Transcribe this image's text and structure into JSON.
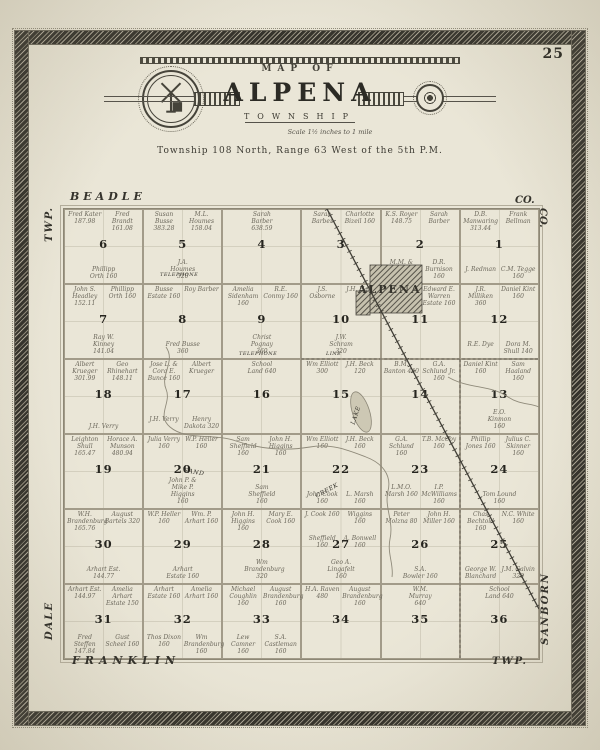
{
  "colors": {
    "paper": "#eae6d7",
    "paper_edge": "#ddd8c6",
    "ink": "#3c3a31",
    "map_line": "#a29b89",
    "owner_ink": "#6b675b",
    "border_band": "#36342d",
    "town_fill": "#56534a"
  },
  "page": {
    "number": "25"
  },
  "title": {
    "arc": "MAP OF",
    "name": "ALPENA",
    "subtitle": "TOWNSHIP",
    "scale": "Scale 1½ inches to 1 mile",
    "legal": "Township 108 North, Range 63 West of the 5th P.M."
  },
  "edges": {
    "top": "BEADLE",
    "top_right": "CO.",
    "right_top": "CO.",
    "right_bottom": "SANBORN",
    "left_top": "TWP.",
    "left_bottom": "DALE",
    "bottom_left": "FRANKLIN",
    "bottom_right": "TWP."
  },
  "map": {
    "labels": [
      {
        "name": "town-label",
        "text": "ALPENA",
        "x": 294,
        "y": 74,
        "size": 11,
        "ls": 2,
        "bold": true
      },
      {
        "name": "lake-label",
        "text": "LAKE",
        "x": 289,
        "y": 212,
        "size": 6,
        "rot": -72
      },
      {
        "name": "creek-label-sand",
        "text": "SAND",
        "x": 120,
        "y": 258,
        "size": 6,
        "rot": 10
      },
      {
        "name": "creek-label-creek",
        "text": "CREEK",
        "x": 252,
        "y": 284,
        "size": 6,
        "rot": -28
      },
      {
        "name": "telephone-label-1",
        "text": "TELEPHONE",
        "x": 96,
        "y": 63,
        "size": 5
      },
      {
        "name": "telephone-label-2",
        "text": "TELEPHONE",
        "x": 175,
        "y": 142,
        "size": 5
      },
      {
        "name": "line-label",
        "text": "LINE",
        "x": 262,
        "y": 142,
        "size": 5
      }
    ],
    "sections": [
      {
        "num": 6,
        "names": [
          "Fred Kater 187.98",
          "Fred Brandt 161.08",
          "Phillipp Orth 160"
        ]
      },
      {
        "num": 5,
        "names": [
          "Susan Busse 383.28",
          "M.L. Houmes 158.04",
          "J.A. Houmes 320"
        ]
      },
      {
        "num": 4,
        "names": [
          "Sarah Barber 638.59"
        ]
      },
      {
        "num": 3,
        "names": [
          "Sarah Barber",
          "Charlotte Bizeil 160"
        ]
      },
      {
        "num": 2,
        "names": [
          "K.S. Royer 148.75",
          "Sarah Barber",
          "M.M. & Anne Burnison",
          "D.R. Burnison 160"
        ]
      },
      {
        "num": 1,
        "names": [
          "D.B. Manwaring 313.44",
          "Frank Bellman",
          "J. Redman",
          "C.M. Tegge 160"
        ]
      },
      {
        "num": 7,
        "names": [
          "John S. Headley 152.11",
          "Phillipp Orth 160",
          "Ray W. Kinney 141.04"
        ]
      },
      {
        "num": 8,
        "names": [
          "Busse Estate 160",
          "Roy Barber",
          "Fred Busse 360"
        ]
      },
      {
        "num": 9,
        "names": [
          "Amelia Sidenham 160",
          "R.E. Conmy 160",
          "Christ Pognay 360"
        ]
      },
      {
        "num": 10,
        "names": [
          "J.S. Osborne",
          "J.H. Hale",
          "J.W. Schram 320"
        ]
      },
      {
        "num": 11,
        "names": [
          "Daniel Kint 160",
          "Edward E. Warren Estate 160"
        ]
      },
      {
        "num": 12,
        "names": [
          "J.R. Milliken 360",
          "Daniel Kint 160",
          "R.E. Dye",
          "Dora M. Shull 140"
        ]
      },
      {
        "num": 18,
        "names": [
          "Albert Krueger 301.99",
          "Geo Rhinehart 148.11",
          "J.H. Verry"
        ]
      },
      {
        "num": 17,
        "names": [
          "Jose L. & Cora E. Bunce 160",
          "Albert Krueger",
          "J.H. Verry",
          "Henry Dakota 320"
        ]
      },
      {
        "num": 16,
        "names": [
          "School Land 640"
        ]
      },
      {
        "num": 15,
        "names": [
          "Wm Elliott 300",
          "J.H. Beck 120"
        ]
      },
      {
        "num": 14,
        "names": [
          "B.M. Banton 440",
          "G.A. Schlund Jr. 160"
        ]
      },
      {
        "num": 13,
        "names": [
          "Daniel Kint 160",
          "Sam Haaland 160",
          "E.O. Kinmon 160"
        ]
      },
      {
        "num": 19,
        "names": [
          "Leighton Shull 165.47",
          "Horace A. Munson 480.94"
        ]
      },
      {
        "num": 20,
        "names": [
          "Julia Verry 160",
          "W.P. Heller 160",
          "John P. & Mike P. Higgins 160"
        ]
      },
      {
        "num": 21,
        "names": [
          "Sam Sheffield 160",
          "John H. Higgins 160",
          "Sam Sheffield 160"
        ]
      },
      {
        "num": 22,
        "names": [
          "Wm Elliott 160",
          "J.H. Beck 160",
          "John Cook 160",
          "L. Marsh 160"
        ]
      },
      {
        "num": 23,
        "names": [
          "G.A. Schlund 160",
          "T.B. McCoy 160",
          "L.M.O. Marsh 160",
          "I.P. McWilliams 160"
        ]
      },
      {
        "num": 24,
        "names": [
          "Phillip Jones 160",
          "Julius C. Skinner 160",
          "Tom Lound 160"
        ]
      },
      {
        "num": 30,
        "names": [
          "W.H. Brandenburg 165.76",
          "August Bartels 320",
          "Arhart Est. 144.77"
        ]
      },
      {
        "num": 29,
        "names": [
          "W.P. Heller 160",
          "Wm. P. Arhart 160",
          "Arhart Estate 160"
        ]
      },
      {
        "num": 28,
        "names": [
          "John H. Higgins 160",
          "Mary E. Cook 160",
          "Wm Brandenburg 320"
        ]
      },
      {
        "num": 27,
        "names": [
          "J. Cook 160",
          "Wiggins 160",
          "Sheffield 160",
          "A. Bonwell 160",
          "Geo A. Lingafelt 160"
        ]
      },
      {
        "num": 26,
        "names": [
          "Peter Molzna 80",
          "John H. Miller 160",
          "S.A. Bowler 160"
        ]
      },
      {
        "num": 25,
        "names": [
          "Chas Bechtold 160",
          "N.C. White 160",
          "George W. Blanchard",
          "J.M. Galvin 320"
        ]
      },
      {
        "num": 31,
        "names": [
          "Arhart Est. 144.97",
          "Amelia Arhart Estate 150",
          "Fred Steffen 147.84",
          "Gust Scheel 160"
        ]
      },
      {
        "num": 32,
        "names": [
          "Arhart Estate 160",
          "Amelia Arhart 160",
          "Thos Dixon 160",
          "Wm Brandenburg 160"
        ]
      },
      {
        "num": 33,
        "names": [
          "Michael Coughlin 160",
          "August Brandenburg 160",
          "Lew Camner 160",
          "S.A. Castleman 160"
        ]
      },
      {
        "num": 34,
        "names": [
          "H.A. Raven 480",
          "August Brandenburg 160"
        ]
      },
      {
        "num": 35,
        "names": [
          "W.M. Murray 640"
        ]
      },
      {
        "num": 36,
        "names": [
          "School Land 640"
        ]
      }
    ]
  }
}
